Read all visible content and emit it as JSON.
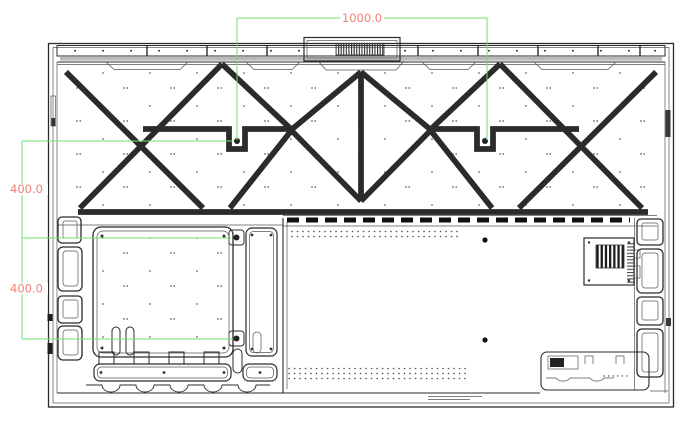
{
  "dimensions": {
    "top_width": "1000.0",
    "left_upper": "400.0",
    "left_lower": "400.0"
  },
  "colors": {
    "dimension_line": "#6fe06f",
    "dimension_text": "#f08078",
    "drawing_line": "#2b2b2b",
    "background": "#ffffff"
  }
}
